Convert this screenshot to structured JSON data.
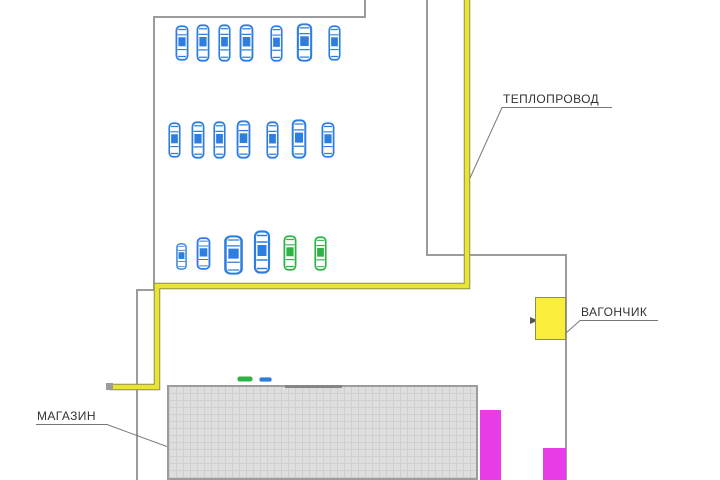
{
  "labels": {
    "heat_pipeline": "ТЕПЛОПРОВОД",
    "trailer": "ВАГОНЧИК",
    "shop": "МАГАЗИН"
  },
  "colors": {
    "car_blue": "#2e7ee0",
    "car_green": "#2db245",
    "pipeline_yellow": "#e9e532",
    "pipeline_edge": "#8f8f4a",
    "trailer_yellow": "#f9ee3c",
    "magenta": "#e93ce9",
    "building_fill": "#dedede",
    "building_grid": "#cfcfcf",
    "boundary_gray": "#9c9c9c",
    "leader_gray": "#777777",
    "text": "#333333"
  },
  "parking": {
    "rows": [
      {
        "name": "row-1",
        "cars": [
          {
            "x": 174,
            "y": 25,
            "w": 16,
            "h": 36,
            "color": "car_blue"
          },
          {
            "x": 195,
            "y": 24,
            "w": 16,
            "h": 38,
            "color": "car_blue"
          },
          {
            "x": 217,
            "y": 24,
            "w": 15,
            "h": 38,
            "color": "car_blue"
          },
          {
            "x": 238,
            "y": 24,
            "w": 17,
            "h": 38,
            "color": "car_blue"
          },
          {
            "x": 269,
            "y": 25,
            "w": 15,
            "h": 37,
            "color": "car_blue"
          },
          {
            "x": 295,
            "y": 23,
            "w": 19,
            "h": 39,
            "color": "car_blue"
          },
          {
            "x": 327,
            "y": 25,
            "w": 15,
            "h": 36,
            "color": "car_blue"
          }
        ]
      },
      {
        "name": "row-2",
        "cars": [
          {
            "x": 167,
            "y": 122,
            "w": 15,
            "h": 36,
            "color": "car_blue"
          },
          {
            "x": 190,
            "y": 121,
            "w": 16,
            "h": 38,
            "color": "car_blue"
          },
          {
            "x": 212,
            "y": 121,
            "w": 15,
            "h": 38,
            "color": "car_blue"
          },
          {
            "x": 235,
            "y": 120,
            "w": 17,
            "h": 39,
            "color": "car_blue"
          },
          {
            "x": 265,
            "y": 121,
            "w": 15,
            "h": 38,
            "color": "car_blue"
          },
          {
            "x": 290,
            "y": 119,
            "w": 18,
            "h": 40,
            "color": "car_blue"
          },
          {
            "x": 320,
            "y": 122,
            "w": 16,
            "h": 36,
            "color": "car_blue"
          }
        ]
      },
      {
        "name": "row-3",
        "cars": [
          {
            "x": 175,
            "y": 243,
            "w": 13,
            "h": 27,
            "color": "car_blue"
          },
          {
            "x": 195,
            "y": 237,
            "w": 17,
            "h": 33,
            "color": "car_blue"
          },
          {
            "x": 222,
            "y": 235,
            "w": 23,
            "h": 40,
            "color": "car_blue"
          },
          {
            "x": 252,
            "y": 230,
            "w": 20,
            "h": 44,
            "color": "car_blue"
          },
          {
            "x": 282,
            "y": 235,
            "w": 16,
            "h": 36,
            "color": "car_green"
          },
          {
            "x": 313,
            "y": 236,
            "w": 15,
            "h": 35,
            "color": "car_green"
          }
        ]
      }
    ],
    "mini_cars": [
      {
        "x": 237,
        "y": 376,
        "w": 16,
        "h": 6,
        "color": "car_green"
      },
      {
        "x": 259,
        "y": 377,
        "w": 13,
        "h": 5,
        "color": "car_blue"
      }
    ]
  }
}
